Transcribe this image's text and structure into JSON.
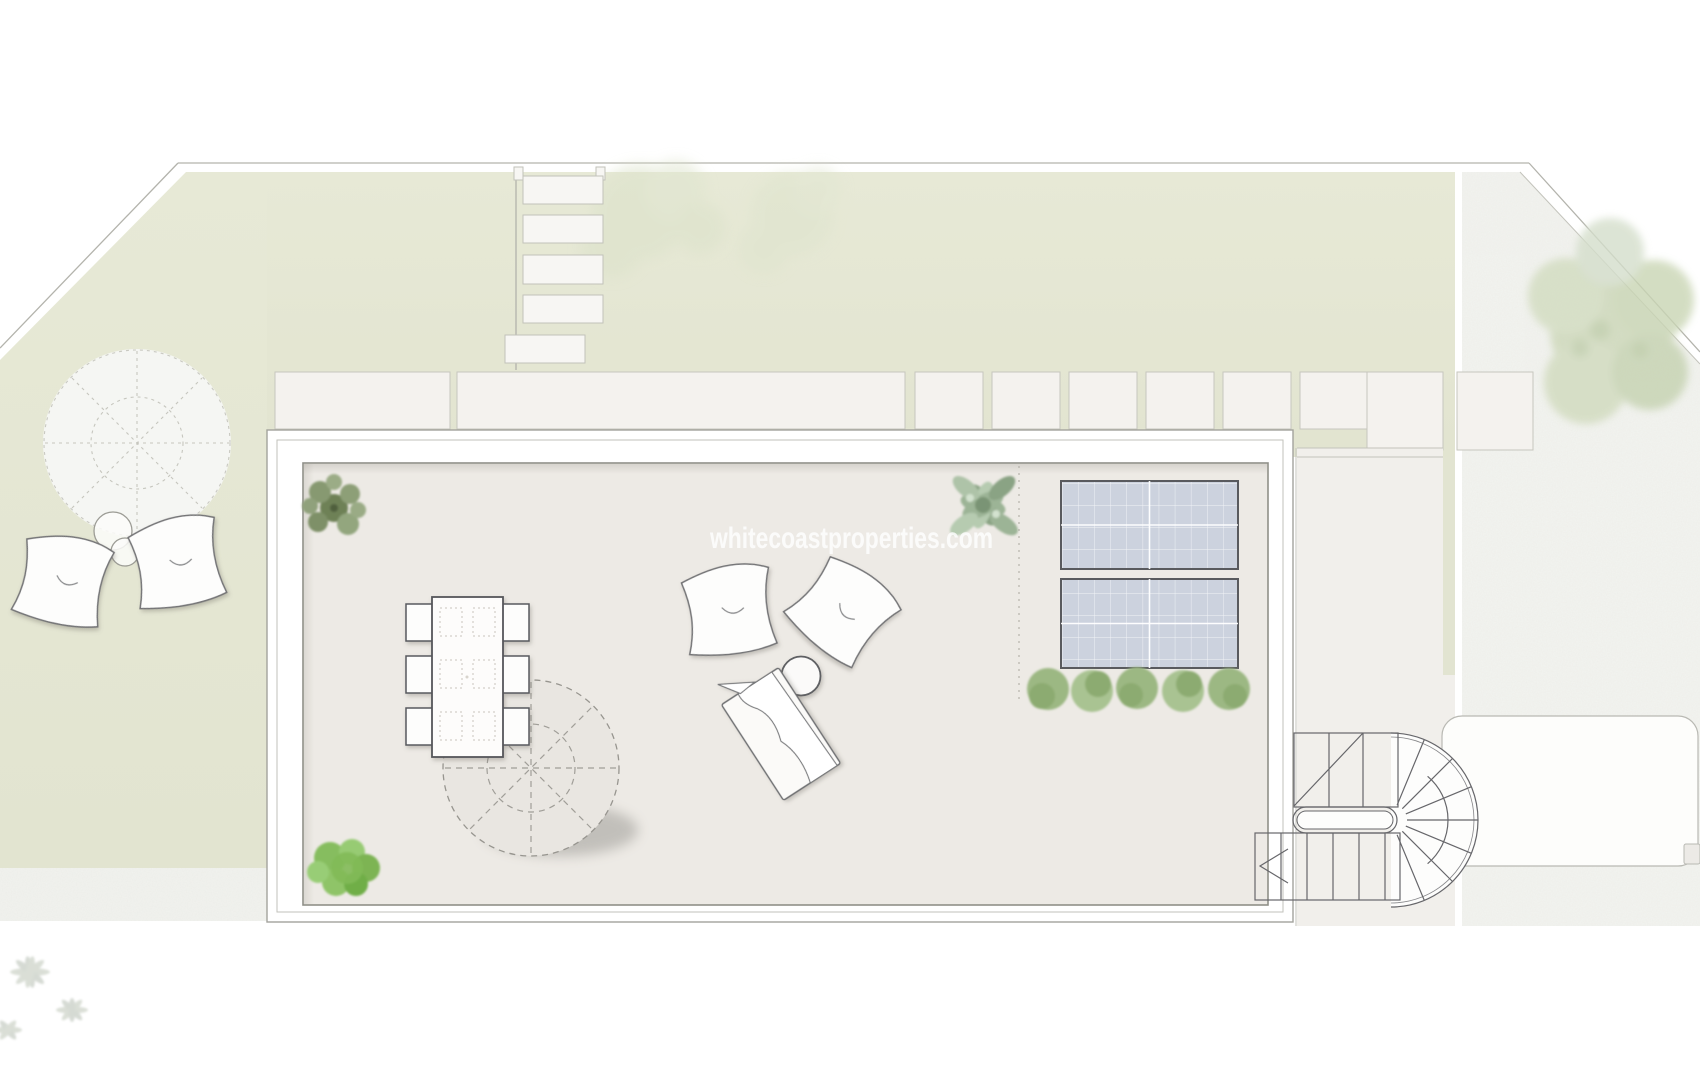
{
  "watermark": {
    "text": "whitecoastproperties.com",
    "color": "#ffffff"
  },
  "plan": {
    "title": "roof-terrace-site-plan",
    "colors": {
      "garden": "#e5e7d3",
      "gravel": "#f3f4f0",
      "terrace_floor": "#edeae5",
      "parapet_wall": "#ffffff",
      "solar_panel": "#ccd2de",
      "solar_panel_border": "#595a5e",
      "outline": "#66666a",
      "boundary_line": "#b3b3ac",
      "foliage_bright": "#86bd5e",
      "foliage_sage": "#9cb496",
      "tree_canopy": "#ccd7b8"
    },
    "inventory": {
      "solar_panels": 2,
      "dining_tables": 1,
      "dining_chairs": 6,
      "parasols": 2,
      "bean_bags": 4,
      "sun_loungers": 1,
      "side_tables": 3,
      "stepping_stones": 5,
      "paver_slabs": 2,
      "paver_squares": 8,
      "staircases": 1,
      "shrubs": 5,
      "trees": 3,
      "vehicles": 1
    }
  }
}
